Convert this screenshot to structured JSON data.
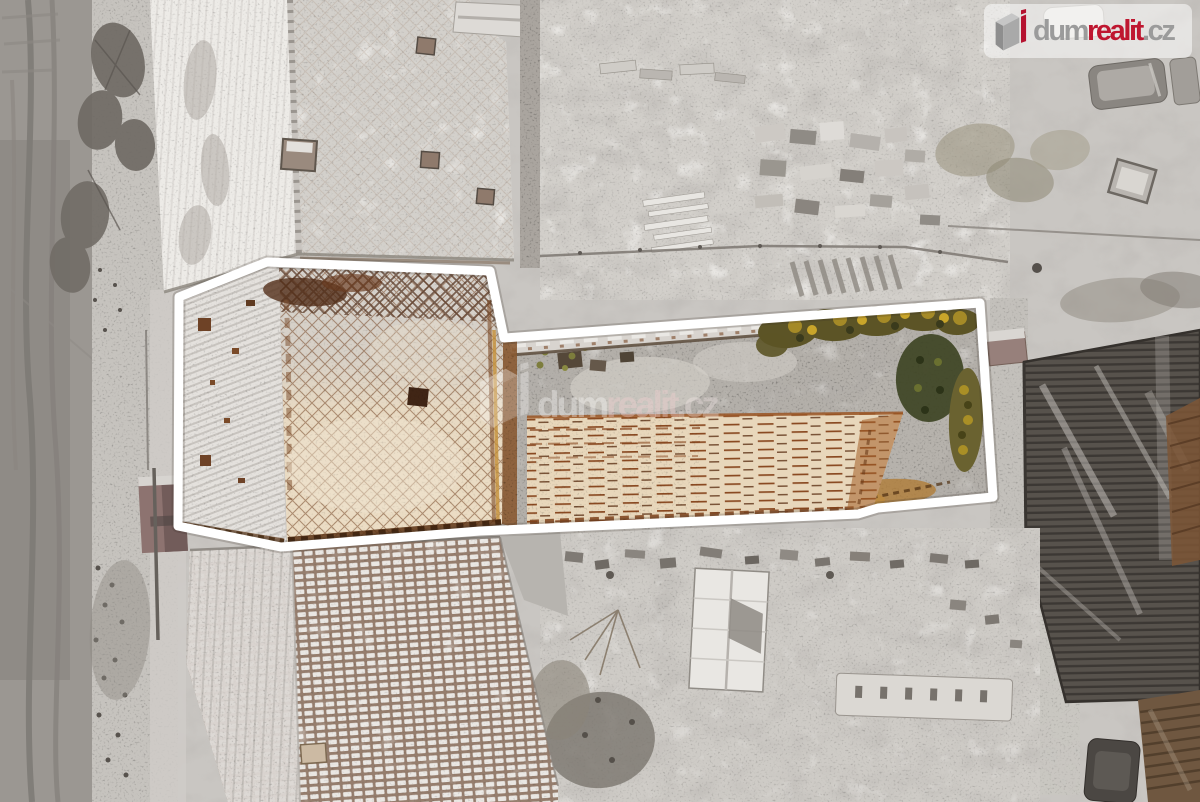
{
  "scene": {
    "alt": "Winter aerial drone photo of a property. A thick white outline highlights the offered parcel containing a rusted lattice-patterned roof building, a narrow snowy courtyard, a long tan corrugated roof and a garden with yellow-green hedges. Surrounding lots, roads and roofs are desaturated gray."
  },
  "branding": {
    "logo": {
      "part1": "dum",
      "part2": "realit",
      "part3": ".cz"
    },
    "colors": {
      "red": "#bf1730",
      "gray": "#9b9b9b",
      "outline": "#ffffff"
    }
  },
  "watermark": {
    "part1": "dum",
    "part2": "realit",
    "part3": ".cz"
  }
}
